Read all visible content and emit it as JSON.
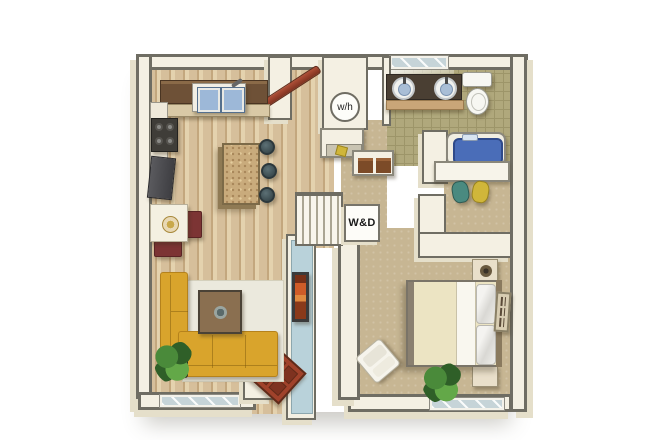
{
  "figure": "apartment-floor-plan",
  "labels": {
    "water_heater": "w/h",
    "washer_dryer": "W&D"
  },
  "colors": {
    "wall-face": "#f4f0e3",
    "wall-edge": "#6f6d63",
    "wall-out": "#e5dfca",
    "wood-base": "#d6bf9b",
    "wood-dark": "#c3a77e",
    "wood-light": "#e4d2ae",
    "carpet": "#c7b693",
    "tile": "#b0a87c",
    "tile-line": "#9d9569",
    "rug": "#ebe9dd",
    "window-glass": "#c6d4d8",
    "accent-blue": "#b9d2da",
    "door-red": "#a0422b",
    "door-red-dark": "#7e3220",
    "sofa-yellow": "#d9a42c",
    "sofa-dark": "#b5821c",
    "island-tan": "#c9ab7c",
    "tub-blue": "#4a6db8",
    "clothes-teal": "#4a8a80",
    "clothes-yellow": "#d0b63a",
    "plant-a": "#4a8a3a",
    "plant-b": "#2f5f28",
    "plant-c": "#63a848",
    "art-orange": "#cf5c28",
    "vanity-brown": "#4a3f33",
    "counter-brown": "#6e5137",
    "counter-shelf": "#d9c9a6",
    "chair-maroon": "#7c3434",
    "appliance-dark": "#3f3d38"
  }
}
